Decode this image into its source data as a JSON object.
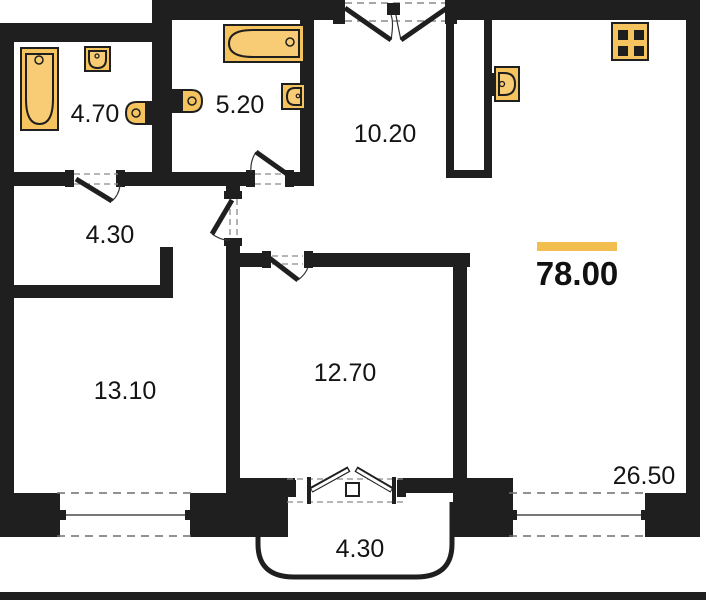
{
  "plan": {
    "type": "apartment-floor-plan",
    "total": {
      "area": "78.00",
      "accent_bar_color": "#f2be4f"
    },
    "rooms": [
      {
        "name": "bathroom-1",
        "area": "4.70"
      },
      {
        "name": "bathroom-2",
        "area": "5.20"
      },
      {
        "name": "hallway",
        "area": "10.20"
      },
      {
        "name": "corridor",
        "area": "4.30"
      },
      {
        "name": "room-1",
        "area": "13.10"
      },
      {
        "name": "room-2",
        "area": "12.70"
      },
      {
        "name": "kitchen-living-room",
        "area": "26.50"
      },
      {
        "name": "balcony",
        "area": "4.30"
      }
    ],
    "fixtures": [
      "bathtub",
      "wall-sink",
      "toilet",
      "bathtub",
      "toilet",
      "sink",
      "kitchen-sink",
      "stove"
    ],
    "colors": {
      "wall": "#1f1f1f",
      "fixture_fill": "#f6c45f",
      "background": "#ffffff",
      "dash_line": "#8a8a8a"
    }
  }
}
